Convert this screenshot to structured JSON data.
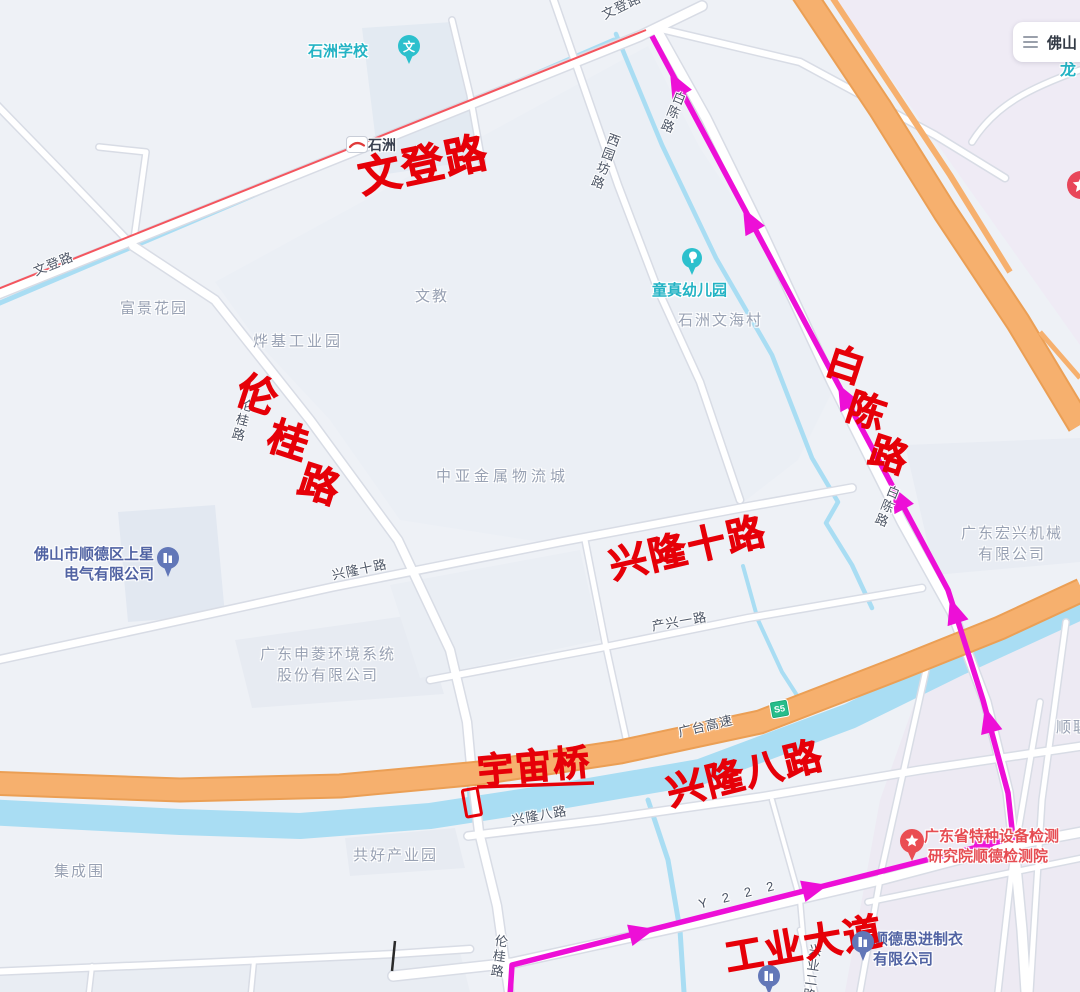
{
  "search": {
    "city": "佛山"
  },
  "map_ui": {
    "expressway_badge": "S5"
  },
  "road_labels": {
    "wendeng_left": "文登路",
    "wendeng_top": "文登路",
    "xiyuanfang": "西园坊路",
    "baichen_top": "白陈路",
    "baichen_mid": "白陈路",
    "xinglong_shi": "兴隆十路",
    "chanxing_yi": "产兴一路",
    "guangtai": "广台高速",
    "xinglong_ba": "兴隆八路",
    "lungui_mid": "伦桂路",
    "lungui_bottom": "伦桂路",
    "y222": "Y 2 2 2",
    "xingye": "兴业二路"
  },
  "area_labels": {
    "fujing": "富景花园",
    "yeji": "烨基工业园",
    "wenjiao": "文教",
    "shizhou_wenhai": "石洲文海村",
    "zhongya": "中亚金属物流城",
    "jicheng": "集成围",
    "gonghao": "共好产业园",
    "shunlian": "顺联",
    "long_partial": "龙"
  },
  "stations": {
    "shizhou": "石洲"
  },
  "pois": {
    "shizhou_school": "石洲学校",
    "school_glyph": "文",
    "tongzhen": "童真幼儿园",
    "shangxing_line1": "佛山市顺德区上星",
    "shangxing_line2": "电气有限公司",
    "shenling_line1": "广东申菱环境系统",
    "shenling_line2": "股份有限公司",
    "hongxing_line1": "广东宏兴机械",
    "hongxing_line2": "有限公司",
    "tejian_line1": "广东省特种设备检测",
    "tejian_line2": "研究院顺德检测院",
    "sijin_line1": "顺德思进制衣",
    "sijin_line2": "有限公司"
  },
  "annotations": {
    "wendeng": "文登路",
    "lungui_chars": [
      "伦",
      "桂",
      "路"
    ],
    "baichen_chars": [
      "白",
      "陈",
      "路"
    ],
    "xinglong_shi": "兴隆十路",
    "yuzhou_bridge": "宇宙桥",
    "xinglong_ba": "兴隆八路",
    "gongye": "工业大道"
  },
  "colors": {
    "route": "#ed0fd7",
    "annotation_red": "#e60008",
    "highway": "#f6b06e",
    "water": "#a9ddf3",
    "land": "#eef1f6"
  }
}
